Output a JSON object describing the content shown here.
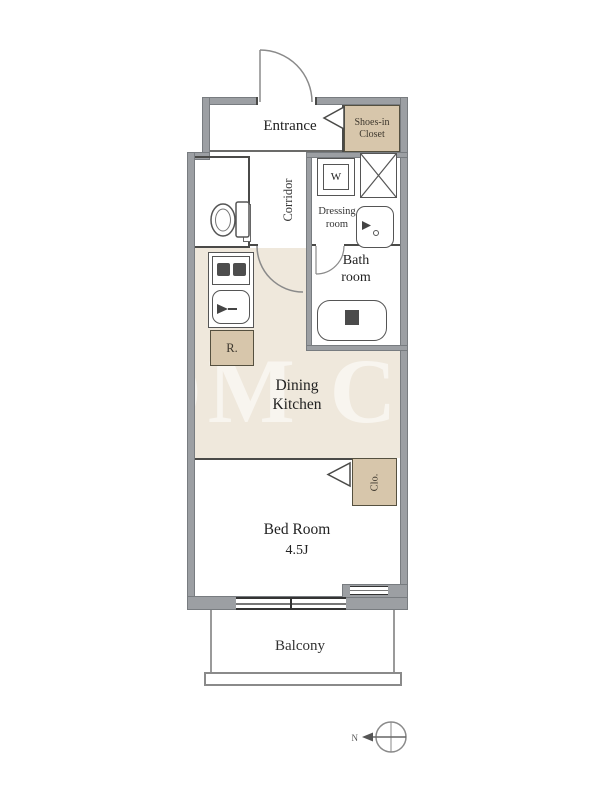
{
  "floorplan": {
    "watermark": "OM CO",
    "rooms": {
      "entrance": {
        "label": "Entrance"
      },
      "shoes_in_closet": {
        "label": "Shoes-in Closet"
      },
      "corridor": {
        "label": "Corridor"
      },
      "washing_machine": {
        "label": "W"
      },
      "dressing_room": {
        "label": "Dressing room"
      },
      "bath_room": {
        "label": "Bath room"
      },
      "dining_kitchen": {
        "label": "Dining Kitchen"
      },
      "refrigerator": {
        "label": "R."
      },
      "closet": {
        "label": "Clo."
      },
      "bed_room": {
        "label": "Bed Room",
        "size": "4.5J"
      },
      "balcony": {
        "label": "Balcony"
      }
    },
    "compass": {
      "north": "N"
    },
    "colors": {
      "wall": "#9C9FA3",
      "floor_beige": "#EFE8DC",
      "storage_tan": "#D7C6AB",
      "line_dark": "#4A4A48"
    }
  }
}
